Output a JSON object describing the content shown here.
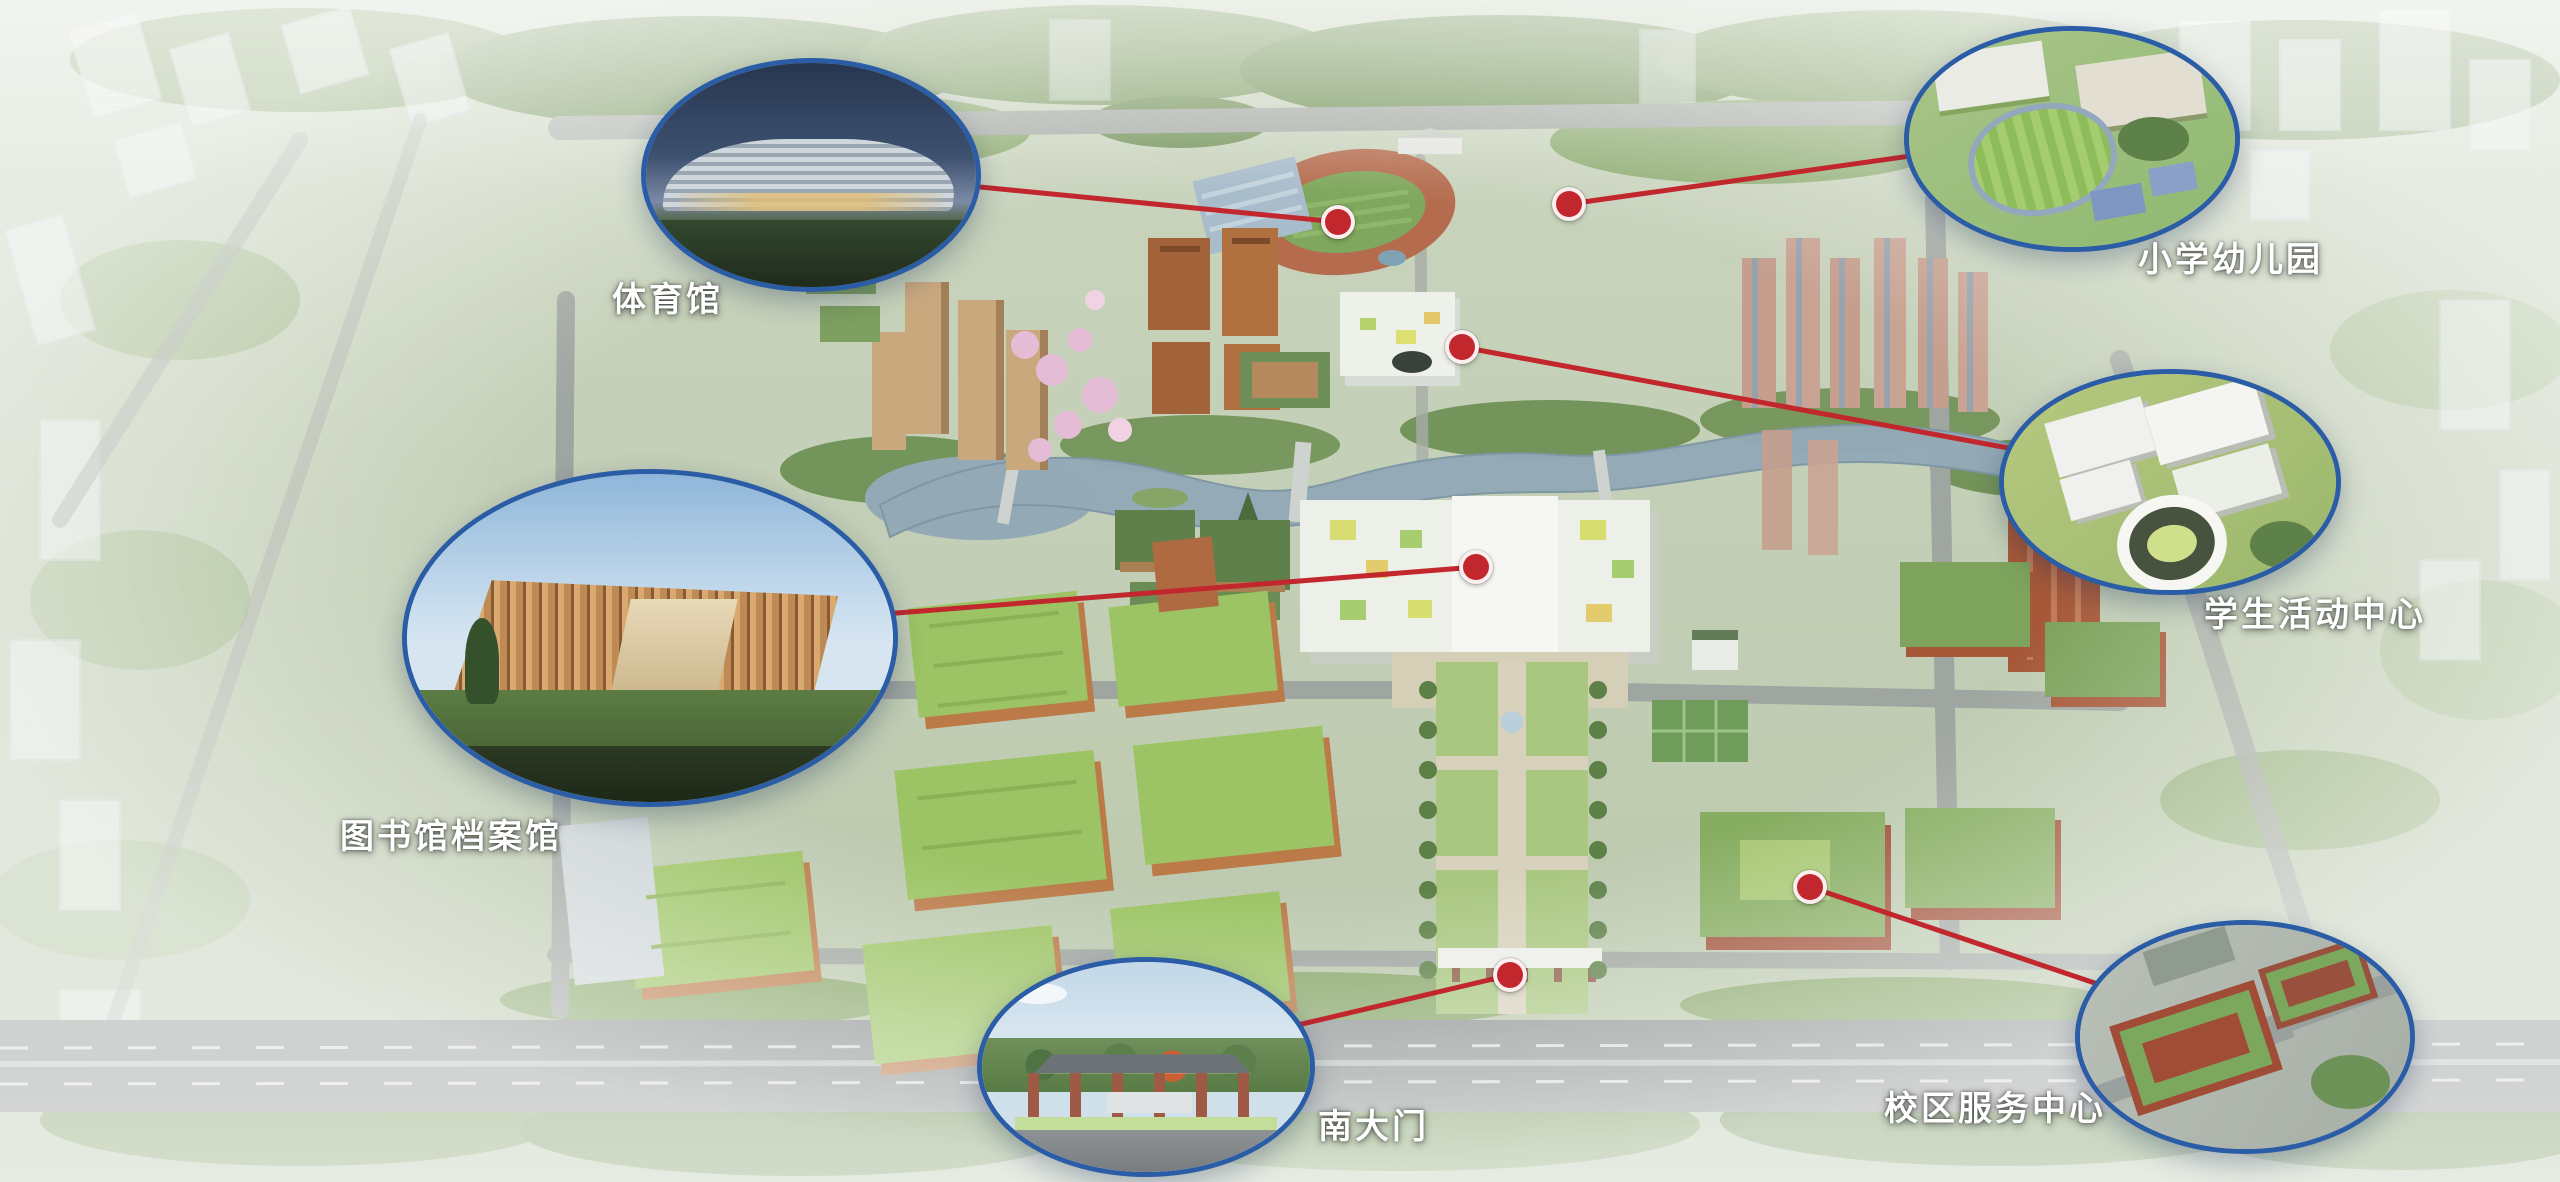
{
  "map": {
    "callouts": [
      {
        "id": "gymnasium",
        "label": "体育馆"
      },
      {
        "id": "primary-school-kindergarten",
        "label": "小学幼儿园"
      },
      {
        "id": "student-activity-center",
        "label": "学生活动中心"
      },
      {
        "id": "library-archives",
        "label": "图书馆档案馆"
      },
      {
        "id": "south-gate",
        "label": "南大门"
      },
      {
        "id": "campus-service-center",
        "label": "校区服务中心"
      }
    ],
    "colors": {
      "marker_red": "#c1272d",
      "connector_red": "#c1272d",
      "callout_border_blue": "#2b5ca6",
      "label_text": "#ffffff"
    }
  }
}
